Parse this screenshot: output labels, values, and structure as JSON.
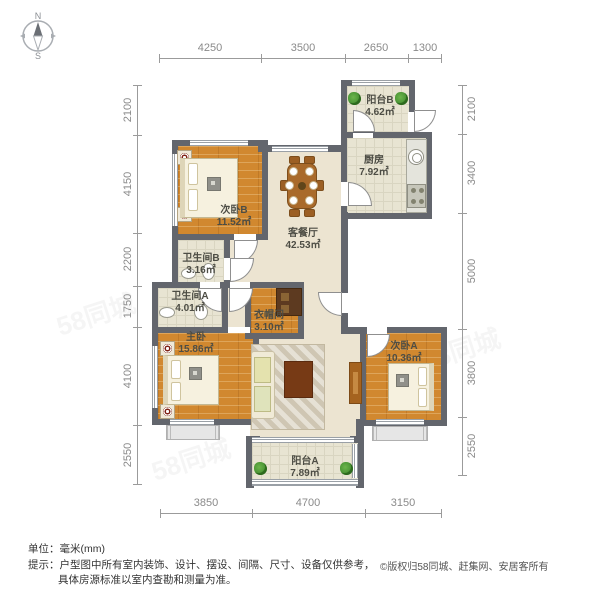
{
  "compass": {
    "n": "N",
    "s": "S"
  },
  "rooms": [
    {
      "name": "阳台B",
      "area": "4.62㎡"
    },
    {
      "name": "厨房",
      "area": "7.92㎡"
    },
    {
      "name": "次卧B",
      "area": "11.52㎡"
    },
    {
      "name": "客餐厅",
      "area": "42.53㎡"
    },
    {
      "name": "卫生间B",
      "area": "3.16㎡"
    },
    {
      "name": "卫生间A",
      "area": "4.01㎡"
    },
    {
      "name": "衣帽间",
      "area": "3.10㎡"
    },
    {
      "name": "主卧",
      "area": "15.86㎡"
    },
    {
      "name": "次卧A",
      "area": "10.36㎡"
    },
    {
      "name": "阳台A",
      "area": "7.89㎡"
    }
  ],
  "dims": {
    "top": [
      "4250",
      "3500",
      "2650",
      "1300"
    ],
    "bottom": [
      "3850",
      "4700",
      "3150"
    ],
    "left": [
      "2100",
      "4150",
      "2200",
      "1750",
      "4100",
      "2550"
    ],
    "right": [
      "2100",
      "3400",
      "5000",
      "3800",
      "2550"
    ]
  },
  "footer": {
    "unit": "单位：毫米(mm)",
    "tip_label": "提示：",
    "tip1": "户型图中所有室内装饰、设计、摆设、间隔、尺寸、设备仅供参考，",
    "tip2": "具体房源标准以室内查勘和测量为准。",
    "copyright": "©版权归58同城、赶集网、安居客所有"
  },
  "watermark": "58同城"
}
